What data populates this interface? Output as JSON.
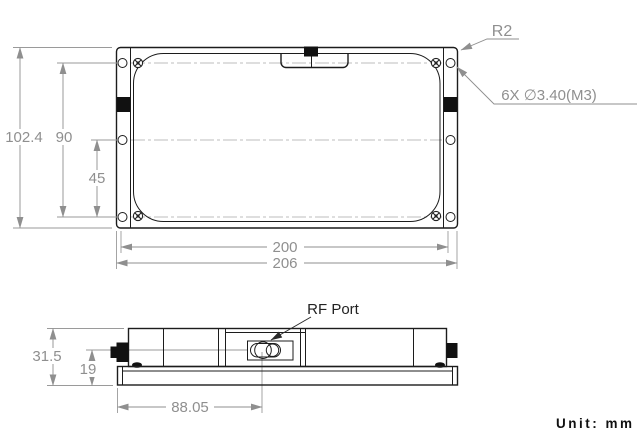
{
  "unit_note": "Unit: mm",
  "colors": {
    "part_line": "#1c1c1c",
    "dimension": "#8f8f8f"
  },
  "top_view": {
    "dims": {
      "overall_height": "102.4",
      "hole_pitch_height": "90",
      "hole_pitch_half": "45",
      "hole_pitch_width": "200",
      "overall_width": "206"
    },
    "callouts": {
      "corner_radius": "R2",
      "mounting_holes": "6X ∅3.40(M3)"
    }
  },
  "side_view": {
    "dims": {
      "overall_height": "31.5",
      "port_center_height": "19",
      "port_center_offset": "88.05"
    },
    "callouts": {
      "rf_port": "RF Port"
    }
  }
}
